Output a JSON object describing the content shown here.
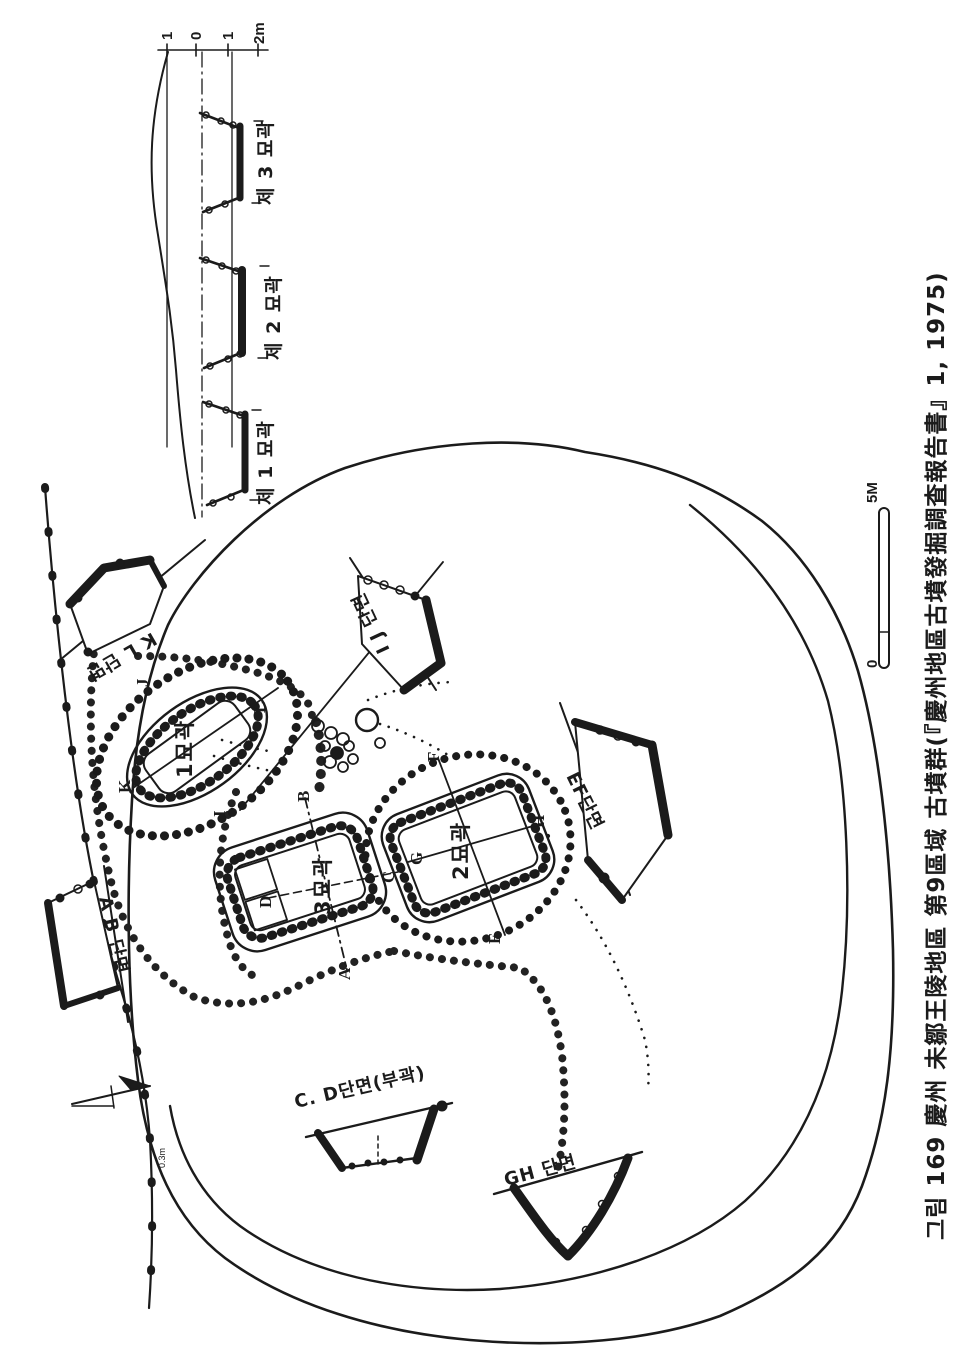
{
  "figure": {
    "caption": "그림 169  慶州 未鄒王陵地區 第9區域 古墳群(『慶州地區古墳發掘調査報告書』1, 1975)"
  },
  "profile": {
    "ruler_ticks": [
      "1",
      "0",
      "1",
      "2m"
    ],
    "pits": [
      {
        "label": "제 1 묘곽"
      },
      {
        "label": "제 2 묘곽"
      },
      {
        "label": "제 3 묘곽"
      }
    ]
  },
  "plan": {
    "tombs": [
      {
        "label": "1묘곽"
      },
      {
        "label": "2묘곽"
      },
      {
        "label": "3묘곽"
      }
    ],
    "points": [
      "A",
      "B",
      "C",
      "D",
      "E",
      "F",
      "G",
      "H",
      "I",
      "J",
      "K",
      "L"
    ],
    "sections": [
      {
        "label": "K L 단면"
      },
      {
        "label": "I J 단면"
      },
      {
        "label": "A B 단면"
      },
      {
        "label": "EF단면"
      },
      {
        "label": "C. D단면(부곽)"
      },
      {
        "label": "GH 단면"
      }
    ],
    "scale_bar": {
      "top": "5M",
      "bottom": "0"
    },
    "spot_height": "0.3m"
  },
  "colors": {
    "ink": "#1b1b1b",
    "paper": "#ffffff"
  }
}
